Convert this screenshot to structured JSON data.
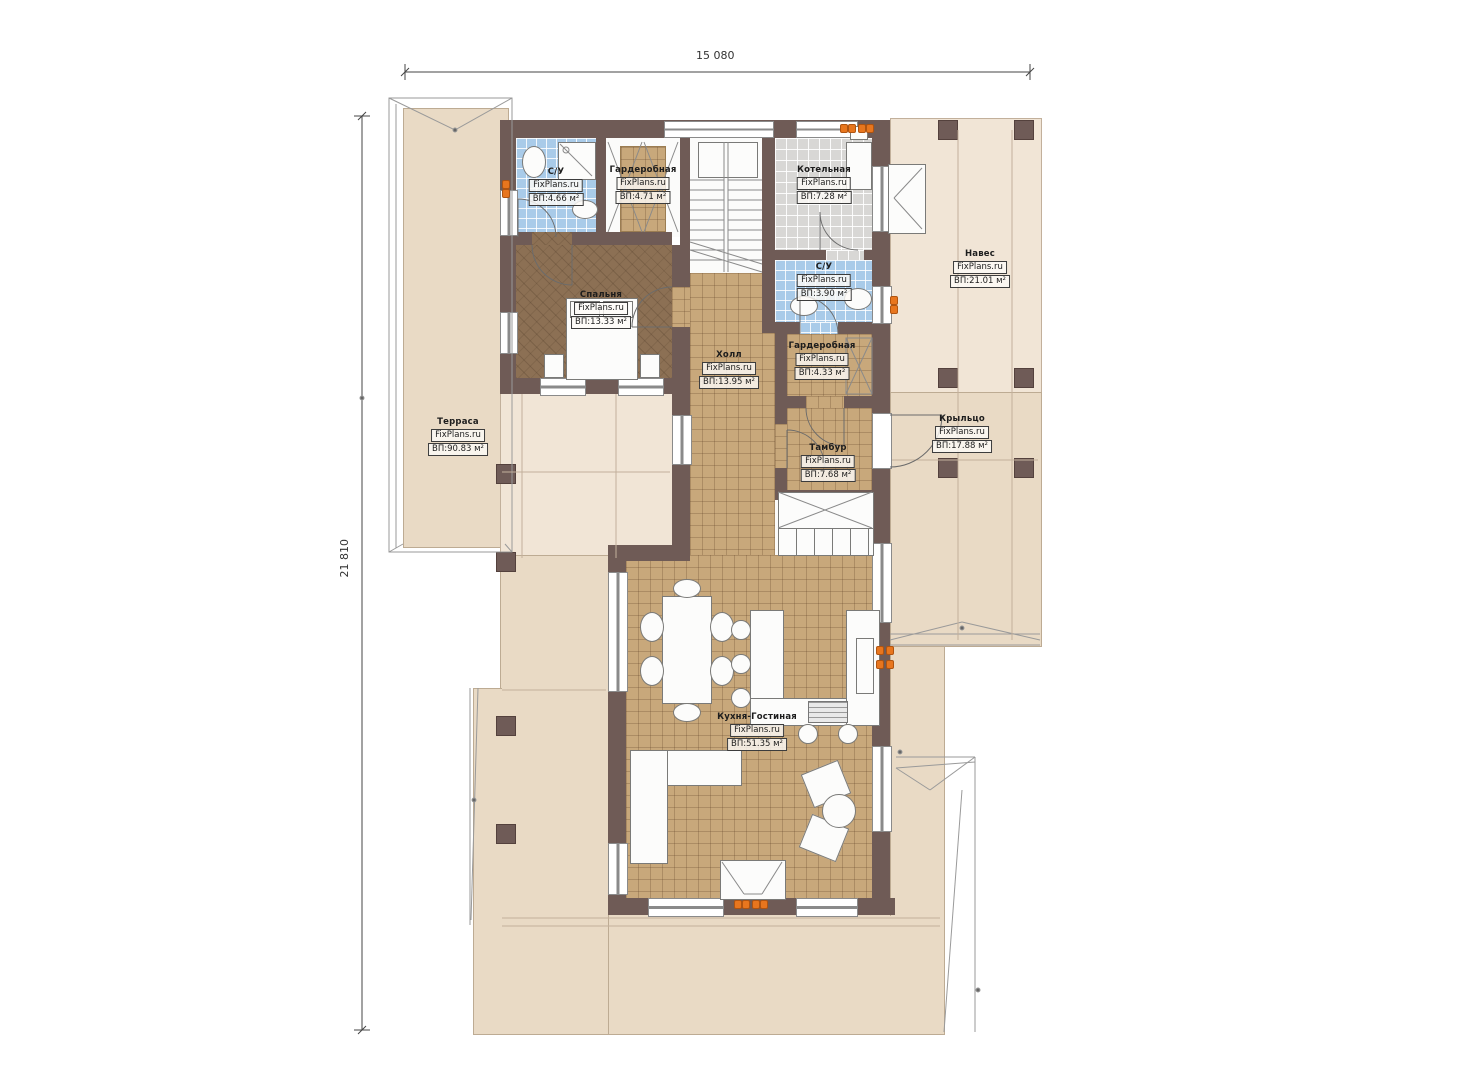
{
  "brand": "FixPlans.ru",
  "dimensions": {
    "width": "15 080",
    "height": "21 810"
  },
  "rooms": {
    "wc1": {
      "name": "С/У",
      "area": "ВП:4.66 м²"
    },
    "wardrobe1": {
      "name": "Гардеробная",
      "area": "ВП:4.71 м²"
    },
    "boiler": {
      "name": "Котельная",
      "area": "ВП:7.28 м²"
    },
    "bedroom": {
      "name": "Спальня",
      "area": "ВП:13.33 м²"
    },
    "wc2": {
      "name": "С/У",
      "area": "ВП:3.90 м²"
    },
    "wardrobe2": {
      "name": "Гардеробная",
      "area": "ВП:4.33 м²"
    },
    "hall": {
      "name": "Холл",
      "area": "ВП:13.95 м²"
    },
    "tambour": {
      "name": "Тамбур",
      "area": "ВП:7.68 м²"
    },
    "canopy": {
      "name": "Навес",
      "area": "ВП:21.01 м²"
    },
    "porch": {
      "name": "Крыльцо",
      "area": "ВП:17.88 м²"
    },
    "terrace": {
      "name": "Терраса",
      "area": "ВП:90.83 м²"
    },
    "kitchen_living": {
      "name": "Кухня-Гостиная",
      "area": "ВП:51.35 м²"
    }
  },
  "colors": {
    "wall": "#6f5b56",
    "floor_tan": "#c8a87b",
    "floor_brown": "#8c7054",
    "tile_blue": "#a9cbe9",
    "tile_gray": "#d8d7d5",
    "deck": "#e9dac5",
    "deck_light": "#f1e5d6",
    "accent_orange": "#e8761e"
  }
}
